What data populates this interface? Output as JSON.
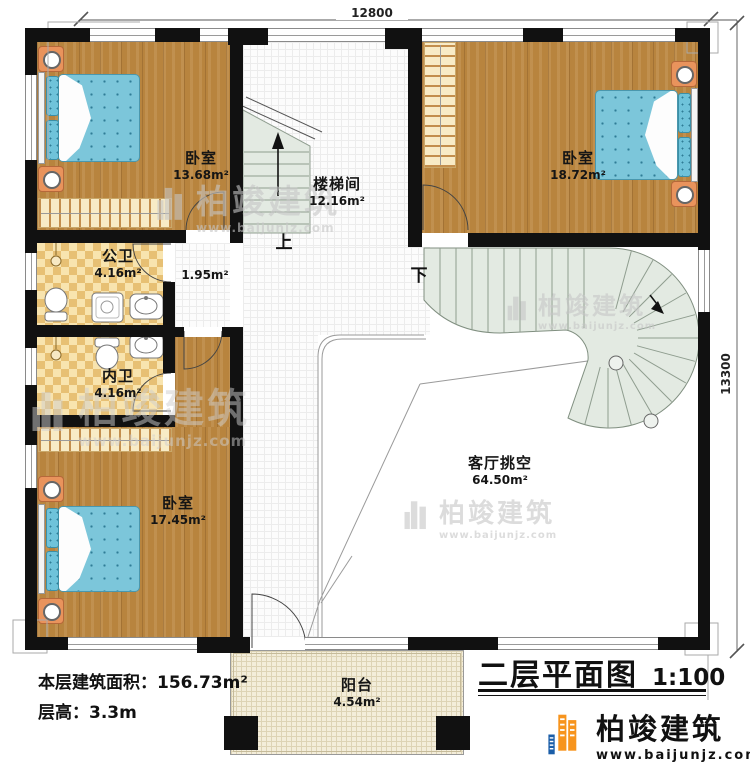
{
  "plan": {
    "dim_top": "12800",
    "dim_right": "13300",
    "up": "上",
    "down": "下"
  },
  "rooms": [
    {
      "name": "卧室",
      "area": "13.68m²"
    },
    {
      "name": "楼梯间",
      "area": "12.16m²"
    },
    {
      "name": "卧室",
      "area": "18.72m²"
    },
    {
      "name": "公卫",
      "area": "4.16m²"
    },
    {
      "name": "",
      "area": "1.95m²"
    },
    {
      "name": "内卫",
      "area": "4.16m²"
    },
    {
      "name": "卧室",
      "area": "17.45m²"
    },
    {
      "name": "客厅挑空",
      "area": "64.50m²"
    },
    {
      "name": "阳台",
      "area": "4.54m²"
    }
  ],
  "info": {
    "area_label": "本层建筑面积：",
    "area_value": "156.73m²",
    "height_label": "层高：",
    "height_value": "3.3m"
  },
  "title": {
    "text": "二层平面图",
    "scale": "1:100"
  },
  "brand": {
    "name": "柏竣建筑",
    "url": "www.baijunjz.com"
  }
}
